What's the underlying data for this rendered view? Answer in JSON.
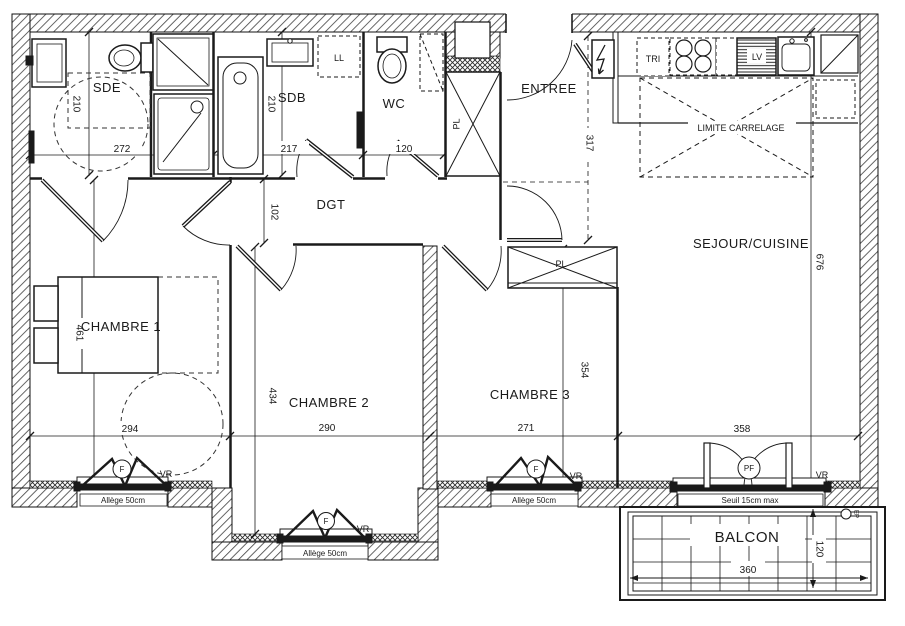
{
  "plan": {
    "type": "apartment-floorplan",
    "rooms": {
      "sde": {
        "label": "SDE",
        "width_cm": "272",
        "depth_cm": "210"
      },
      "sdb": {
        "label": "SDB",
        "width_cm": "217",
        "depth_cm": "210"
      },
      "wc": {
        "label": "WC",
        "width_cm": "120"
      },
      "entree": {
        "label": "ENTREE",
        "depth_cm": "317"
      },
      "dgt": {
        "label": "DGT",
        "width_cm": "102"
      },
      "sejour": {
        "label": "SEJOUR/CUISINE",
        "depth_cm": "676",
        "width_cm": "358"
      },
      "chambre1": {
        "label": "CHAMBRE 1",
        "depth_cm": "461",
        "width_cm": "294"
      },
      "chambre2": {
        "label": "CHAMBRE 2",
        "depth_cm": "434",
        "width_cm": "290"
      },
      "chambre3": {
        "label": "CHAMBRE 3",
        "depth_cm": "354",
        "width_cm": "271"
      },
      "balcon": {
        "label": "BALCON",
        "width_cm": "360",
        "depth_cm": "120"
      }
    },
    "annotations": {
      "pl": "PL",
      "ll": "LL",
      "tri": "TRI",
      "lv": "LV",
      "vr": "VR",
      "f": "F",
      "pf": "PF",
      "ep": "EP",
      "limite_carrelage": "LIMITE CARRELAGE",
      "allege": "Allège 50cm",
      "seuil": "Seuil 15cm max"
    },
    "colors": {
      "line": "#1a1a1a",
      "paper": "#ffffff"
    }
  }
}
